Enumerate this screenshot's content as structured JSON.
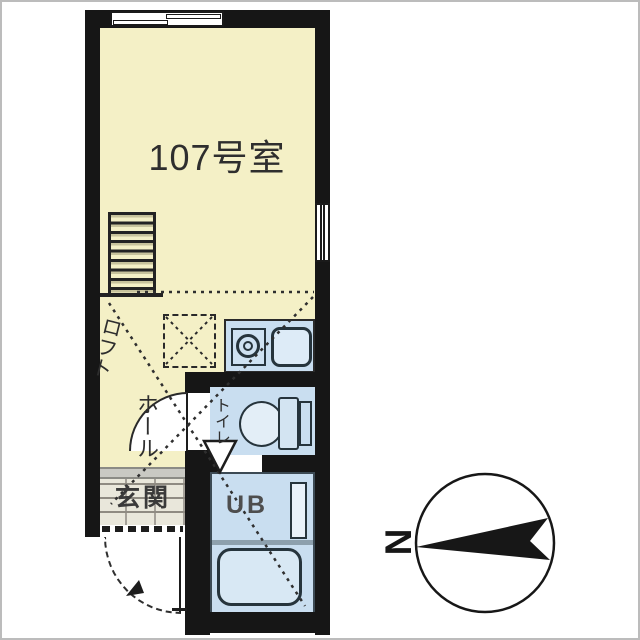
{
  "floor_plan": {
    "unit_label": "107号室",
    "rooms": [
      {
        "id": "main-room",
        "label": "107号室"
      },
      {
        "id": "loft-ladder",
        "label": "ロフト"
      },
      {
        "id": "hall",
        "label": "ホール"
      },
      {
        "id": "entrance",
        "label": "玄関"
      },
      {
        "id": "toilet",
        "label": "トイレ"
      },
      {
        "id": "unit-bath",
        "label": "UB"
      }
    ],
    "fixtures": [
      "loft-ladder",
      "loft-hatch-dashed-box",
      "kitchen-stove",
      "kitchen-sink",
      "toilet-bowl",
      "toilet-tank",
      "bathtub",
      "bath-vanity",
      "sliding-window-top",
      "sliding-window-right",
      "entrance-door-swing",
      "toilet-door-swing",
      "loft-extent-dashed-lines"
    ],
    "compass": {
      "north_label": "N",
      "north_points": "left"
    },
    "colors": {
      "room_fill": "#f4f0c6",
      "wet_area_fill": "#c9def0",
      "wall": "#161616",
      "fixture_line": "#26343c",
      "tile_floor": "#e9e7db",
      "background": "#ffffff"
    }
  }
}
